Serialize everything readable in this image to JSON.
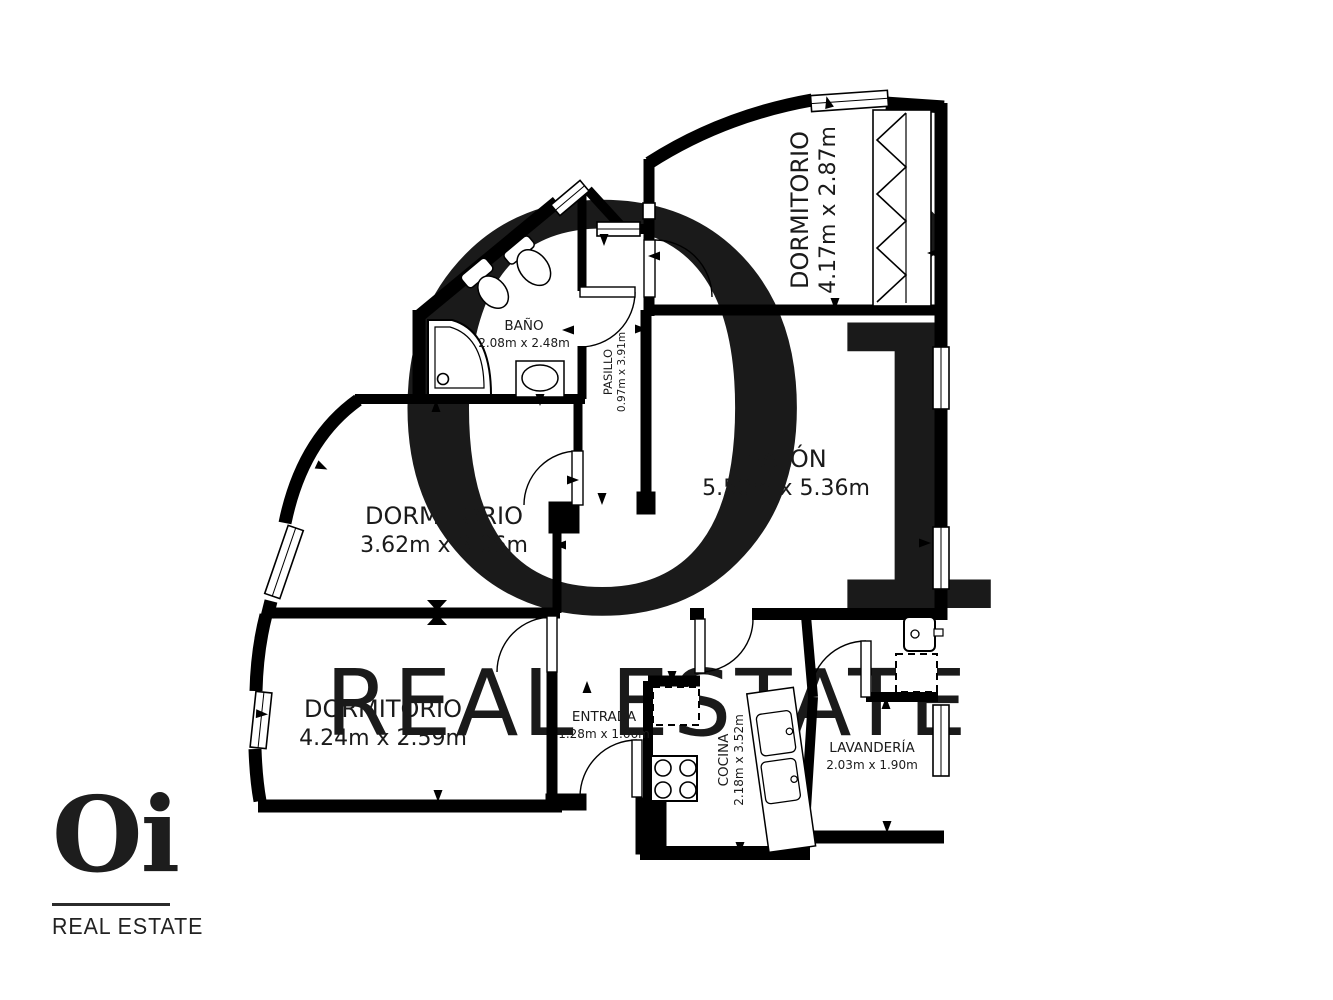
{
  "watermark": {
    "line1": "Oi",
    "line2": "REAL ESTATE"
  },
  "logo": {
    "brand": "Oi",
    "subtitle": "REAL ESTATE"
  },
  "rooms": [
    {
      "id": "dormitorio-top",
      "name": "DORMITORIO",
      "dims": "4.17m x 2.87m"
    },
    {
      "id": "banio",
      "name": "BAÑO",
      "dims": "2.08m x 2.48m"
    },
    {
      "id": "pasillo",
      "name": "PASILLO",
      "dims": "0.97m x 3.91m"
    },
    {
      "id": "salon",
      "name": "SALÓN",
      "dims": "5.50m x 5.36m"
    },
    {
      "id": "dormitorio-middle",
      "name": "DORMITORIO",
      "dims": "3.62m x 3.06m"
    },
    {
      "id": "dormitorio-bottom",
      "name": "DORMITORIO",
      "dims": "4.24m x 2.59m"
    },
    {
      "id": "entrada",
      "name": "ENTRADA",
      "dims": "1.28m x 1.66m"
    },
    {
      "id": "cocina",
      "name": "COCINA",
      "dims": "2.18m x 3.52m"
    },
    {
      "id": "lavanderia",
      "name": "LAVANDERÍA",
      "dims": "2.03m x 1.90m"
    }
  ],
  "colors": {
    "wall": "#000000",
    "background": "#ffffff",
    "watermark_dark": "#ececec",
    "watermark_light": "#f1f1f1",
    "text": "#1a1a1a"
  }
}
